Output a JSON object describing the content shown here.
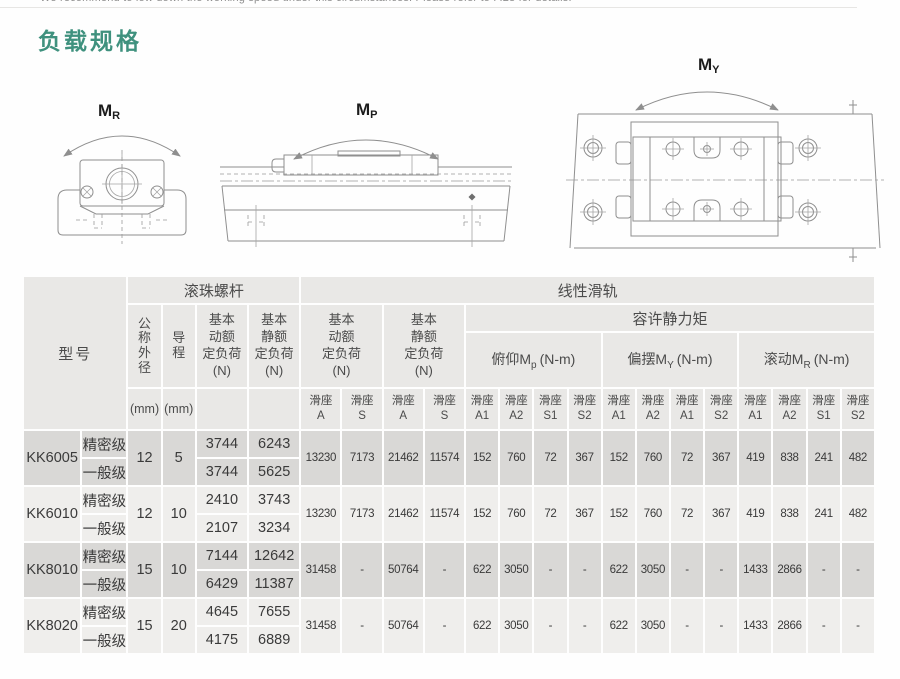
{
  "page": {
    "top_note": "We recommend to low down the working speed under this circumstances. Please refer to P.28 for details.",
    "title": "负载规格"
  },
  "colors": {
    "title_teal": "#3f917e",
    "header_bg": "#e9e8e6",
    "band_dark": "#d9d8d6",
    "band_light": "#efeeec",
    "diagram_line": "#8f8f8f"
  },
  "diagrams": {
    "roll": {
      "label": "M",
      "sub": "R"
    },
    "pitch": {
      "label": "M",
      "sub": "P"
    },
    "yaw": {
      "label": "M",
      "sub": "Y"
    }
  },
  "table": {
    "g": {
      "model": "型号",
      "ball_screw": "滚珠螺杆",
      "linear_guide": "线性滑轨",
      "moment": "容许静力矩"
    },
    "h": {
      "dia": "公\n称\n外\n径",
      "dia_unit": "(mm)",
      "lead": "导\n程",
      "lead_unit": "(mm)",
      "bs_dyn": "基本\n动额\n定负荷\n(N)",
      "bs_st": "基本\n静额\n定负荷\n(N)",
      "lg_dyn": "基本\n动额\n定负荷\n(N)",
      "lg_st": "基本\n静额\n定负荷\n(N)"
    },
    "moments": [
      {
        "prefix": "俯仰M",
        "sub": "p",
        "suffix": "(N-m)"
      },
      {
        "prefix": "偏摆M",
        "sub": "Y",
        "suffix": "(N-m)"
      },
      {
        "prefix": "滚动M",
        "sub": "R",
        "suffix": "(N-m)"
      }
    ],
    "lg_subcols": [
      "滑座\nA",
      "滑座\nS",
      "滑座\nA",
      "滑座\nS"
    ],
    "m_subcols": [
      "滑座\nA1",
      "滑座\nA2",
      "滑座\nS1",
      "滑座\nS2",
      "滑座\nA1",
      "滑座\nA2",
      "滑座\nA1",
      "滑座\nS2",
      "滑座\nA1",
      "滑座\nA2",
      "滑座\nS1",
      "滑座\nS2"
    ],
    "rows": [
      {
        "model": "KK6005",
        "dia": "12",
        "lead": "5",
        "grades": [
          {
            "grade": "精密级",
            "bs_dyn": "3744",
            "bs_st": "6243"
          },
          {
            "grade": "一般级",
            "bs_dyn": "3744",
            "bs_st": "5625"
          }
        ],
        "lg": [
          "13230",
          "7173",
          "21462",
          "11574",
          "152",
          "760",
          "72",
          "367",
          "152",
          "760",
          "72",
          "367",
          "419",
          "838",
          "241",
          "482"
        ]
      },
      {
        "model": "KK6010",
        "dia": "12",
        "lead": "10",
        "grades": [
          {
            "grade": "精密级",
            "bs_dyn": "2410",
            "bs_st": "3743"
          },
          {
            "grade": "一般级",
            "bs_dyn": "2107",
            "bs_st": "3234"
          }
        ],
        "lg": [
          "13230",
          "7173",
          "21462",
          "11574",
          "152",
          "760",
          "72",
          "367",
          "152",
          "760",
          "72",
          "367",
          "419",
          "838",
          "241",
          "482"
        ]
      },
      {
        "model": "KK8010",
        "dia": "15",
        "lead": "10",
        "grades": [
          {
            "grade": "精密级",
            "bs_dyn": "7144",
            "bs_st": "12642"
          },
          {
            "grade": "一般级",
            "bs_dyn": "6429",
            "bs_st": "11387"
          }
        ],
        "lg": [
          "31458",
          "-",
          "50764",
          "-",
          "622",
          "3050",
          "-",
          "-",
          "622",
          "3050",
          "-",
          "-",
          "1433",
          "2866",
          "-",
          "-"
        ]
      },
      {
        "model": "KK8020",
        "dia": "15",
        "lead": "20",
        "grades": [
          {
            "grade": "精密级",
            "bs_dyn": "4645",
            "bs_st": "7655"
          },
          {
            "grade": "一般级",
            "bs_dyn": "4175",
            "bs_st": "6889"
          }
        ],
        "lg": [
          "31458",
          "-",
          "50764",
          "-",
          "622",
          "3050",
          "-",
          "-",
          "622",
          "3050",
          "-",
          "-",
          "1433",
          "2866",
          "-",
          "-"
        ]
      }
    ]
  }
}
